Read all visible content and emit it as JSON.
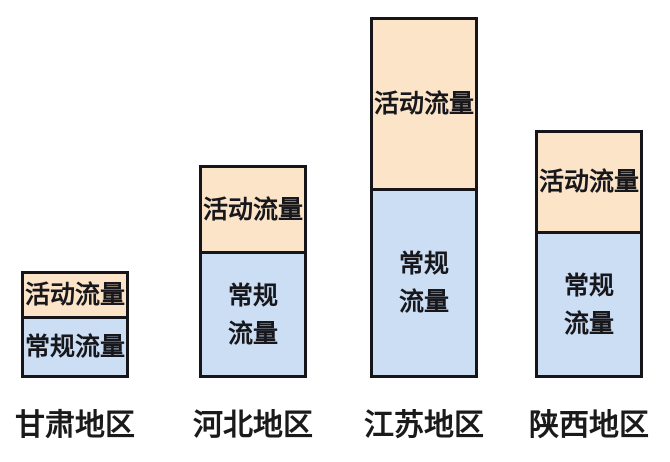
{
  "page": {
    "background": "#ffffff"
  },
  "chart_data": {
    "type": "bar",
    "stacked": true,
    "title": "",
    "xlabel": "",
    "ylabel": "",
    "axes_shown": false,
    "grid": false,
    "legend": "none (segments labeled inline)",
    "categories": [
      "甘肃地区",
      "河北地区",
      "江苏地区",
      "陕西地区"
    ],
    "series": [
      {
        "name": "常规流量",
        "position": "bottom",
        "color": "#cbdef4",
        "values": [
          62,
          127,
          190,
          147
        ]
      },
      {
        "name": "活动流量",
        "position": "top",
        "color": "#fce4c8",
        "values": [
          45,
          86,
          171,
          101
        ]
      }
    ],
    "segment_labels": {
      "activity": [
        [
          "活动流量"
        ],
        [
          "活动流量"
        ],
        [
          "活动流量"
        ],
        [
          "活动流量"
        ]
      ],
      "regular": [
        [
          "常规流量"
        ],
        [
          "常规",
          "流量"
        ],
        [
          "常规",
          "流量"
        ],
        [
          "常规",
          "流量"
        ]
      ]
    },
    "layout": {
      "canvas_width": 670,
      "canvas_height": 462,
      "bar_width": 108,
      "bar_lefts": [
        21,
        199,
        370,
        535
      ],
      "bottom_offset": 84,
      "label_top": 400,
      "border_color": "#15151a",
      "segment_text_color": "#17171c",
      "category_text_color": "#1a1a1a"
    }
  }
}
